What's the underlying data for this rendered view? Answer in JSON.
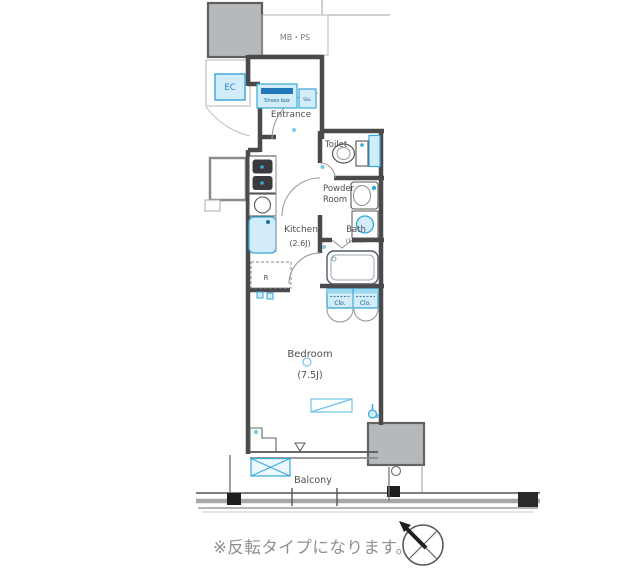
{
  "floor_plan": {
    "note": "※反転タイプになります。",
    "labels": {
      "mb_ps": "MB・PS",
      "ec": "EC",
      "shoes_box": "Shoes box",
      "storage": "Sto.",
      "entrance": "Entrance",
      "toilet": "Toilet",
      "powder_room_line1": "Powder",
      "powder_room_line2": "Room",
      "kitchen": "Kitchen",
      "kitchen_size": "(2.6J)",
      "bath": "Bath",
      "bath_size": "(1216)",
      "closet_left": "Clo.",
      "closet_right": "Clo.",
      "refrigerator": "R",
      "bedroom": "Bedroom",
      "bedroom_size": "(7.5J)",
      "balcony": "Balcony"
    },
    "colors": {
      "wall": "#4a4a4d",
      "fixture_blue": "#35a8d8",
      "fixture_fill": "#d2edf9",
      "dark_blue": "#1f6fa6",
      "gray_fill": "#b6b9bb",
      "note_text": "#8f8f8f"
    }
  }
}
